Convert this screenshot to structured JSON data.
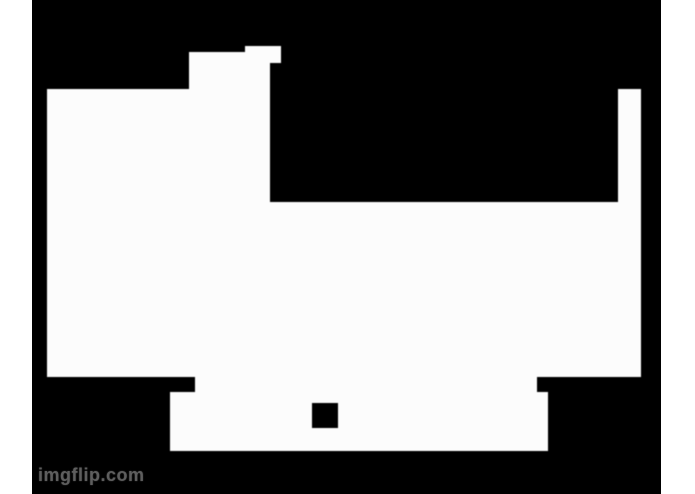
{
  "page": {
    "background_color": "#ffffff"
  },
  "meme": {
    "watermark": "imgflip.com",
    "watermark_color": "#5e5e5e",
    "watermark_pos": {
      "x": 6,
      "y": 466
    },
    "canvas_color": "#000000",
    "shape_color": "#fcfcfc",
    "canvas": {
      "x": 32,
      "y": 0,
      "w": 629,
      "h": 494
    },
    "silhouette": {
      "white_rects": [
        {
          "name": "left-body",
          "x": 15,
          "y": 89,
          "w": 223,
          "h": 288
        },
        {
          "name": "head-block",
          "x": 157,
          "y": 52,
          "w": 81,
          "h": 150
        },
        {
          "name": "head-tab",
          "x": 213,
          "y": 46,
          "w": 36,
          "h": 17
        },
        {
          "name": "mid-body",
          "x": 238,
          "y": 202,
          "w": 371,
          "h": 175
        },
        {
          "name": "right-bar",
          "x": 586,
          "y": 89,
          "w": 23,
          "h": 113
        },
        {
          "name": "lower-band",
          "x": 163,
          "y": 377,
          "w": 342,
          "h": 15
        },
        {
          "name": "bottom-bar",
          "x": 138,
          "y": 392,
          "w": 378,
          "h": 59
        }
      ],
      "black_rects": [
        {
          "name": "bottom-square-hole",
          "x": 280,
          "y": 403,
          "w": 26,
          "h": 25
        }
      ]
    }
  }
}
